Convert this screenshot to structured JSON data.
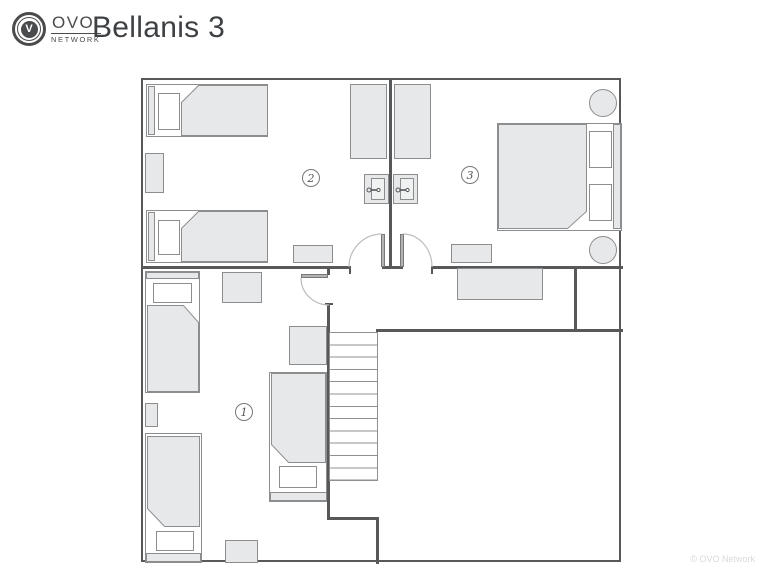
{
  "header": {
    "logo": {
      "brand": "OVO",
      "network": "NETWORK",
      "monogram": "V"
    },
    "title": "Bellanis 3"
  },
  "floorplan": {
    "rooms": [
      {
        "label": "1"
      },
      {
        "label": "2"
      },
      {
        "label": "3"
      }
    ]
  },
  "footer": {
    "watermark": "© OVO Network"
  },
  "colors": {
    "wall": "#57585a",
    "furniture": "#e7e8e9",
    "furnitureBorder": "#8c8d8f",
    "ink": "#3e4144",
    "logoInk": "#4a4b4d",
    "watermark": "#d9dadb",
    "doorLeaf": "#b2b3b5",
    "doorArc": "#bcbdbe"
  }
}
